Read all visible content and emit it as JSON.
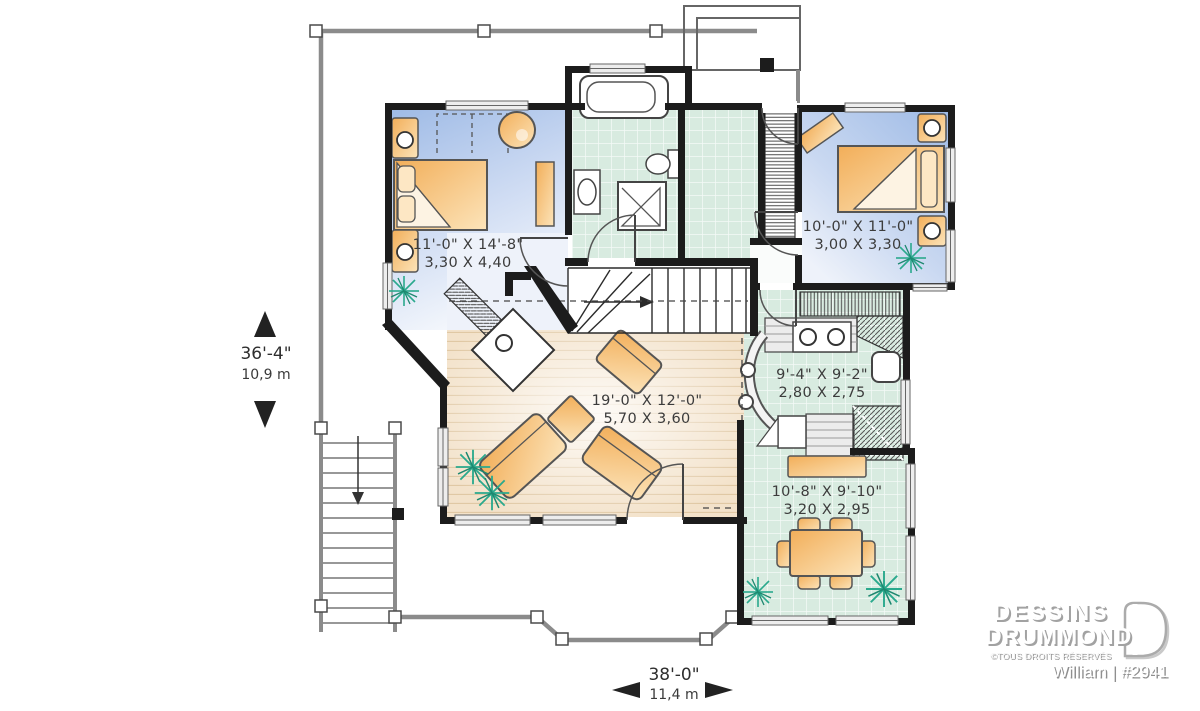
{
  "plan": {
    "rooms": [
      {
        "name": "master-bedroom",
        "imperial": "11'-0\" X 14'-8\"",
        "metric": "3,30 X 4,40"
      },
      {
        "name": "bedroom-2",
        "imperial": "10'-0\" X 11'-0\"",
        "metric": "3,00 X 3,30"
      },
      {
        "name": "kitchen",
        "imperial": "9'-4\" X 9'-2\"",
        "metric": "2,80 X 2,75"
      },
      {
        "name": "living-room",
        "imperial": "19'-0\" X 12'-0\"",
        "metric": "5,70 X 3,60"
      },
      {
        "name": "dining-room",
        "imperial": "10'-8\" X 9'-10\"",
        "metric": "3,20 X 2,95"
      }
    ],
    "overall": {
      "depth_ft": "36'-4\"",
      "depth_m": "10,9 m",
      "width_ft": "38'-0\"",
      "width_m": "11,4 m"
    }
  },
  "branding": {
    "brand_line1": "DESSINS",
    "brand_line2": "DRUMMOND",
    "rights": "©TOUS DROITS RÉSERVÉS",
    "model": "William | #2941"
  },
  "colors": {
    "wall": "#1c1c1c",
    "bedroom_floor": "#9fbbe6",
    "tile_floor": "#d8ebe0",
    "wood_floor": "#f3e2ca",
    "furniture": "#f2ae59",
    "plant": "#2aa98d",
    "deck_rail": "#8b8b8b"
  }
}
